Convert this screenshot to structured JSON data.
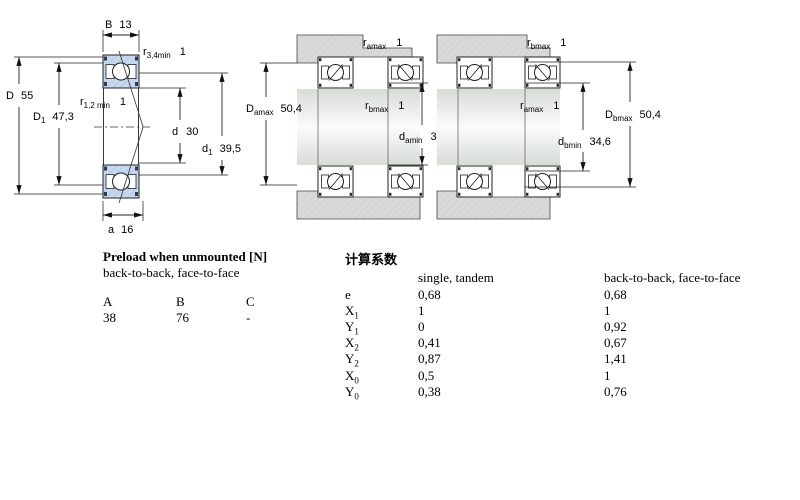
{
  "diagram_left": {
    "dims": {
      "B": {
        "sym": "B",
        "val": "13"
      },
      "r34": {
        "sym": "r",
        "sub": "3,4min",
        "val": "1"
      },
      "D": {
        "sym": "D",
        "val": "55"
      },
      "D1": {
        "sym": "D",
        "sub": "1",
        "val": "47,3"
      },
      "r12": {
        "sym": "r",
        "sub": "1,2 min",
        "val": "1"
      },
      "d": {
        "sym": "d",
        "val": "30"
      },
      "d1": {
        "sym": "d",
        "sub": "1",
        "val": "39,5"
      },
      "a": {
        "sym": "a",
        "val": "16"
      }
    }
  },
  "diagram_mid": {
    "dims": {
      "ramax": {
        "sym": "r",
        "sub": "amax",
        "val": "1"
      },
      "Damax": {
        "sym": "D",
        "sub": "amax",
        "val": "50,4"
      },
      "rbmax": {
        "sym": "r",
        "sub": "bmax",
        "val": "1"
      },
      "damin": {
        "sym": "d",
        "sub": "amin",
        "val": "34,6"
      }
    }
  },
  "diagram_right": {
    "dims": {
      "rbmax": {
        "sym": "r",
        "sub": "bmax",
        "val": "1"
      },
      "ramax": {
        "sym": "r",
        "sub": "amax",
        "val": "1"
      },
      "dbmin": {
        "sym": "d",
        "sub": "bmin",
        "val": "34,6"
      },
      "Dbmax": {
        "sym": "D",
        "sub": "bmax",
        "val": "50,4"
      }
    }
  },
  "preload_table": {
    "title": "Preload when unmounted [N]",
    "subtitle": "back-to-back, face-to-face",
    "columns": [
      "A",
      "B",
      "C"
    ],
    "values": [
      "38",
      "76",
      "-"
    ]
  },
  "factors_table": {
    "title": "计算系数",
    "col_single": "single, tandem",
    "col_btb": "back-to-back, face-to-face",
    "rows": [
      {
        "sym": "e",
        "sub": "",
        "single": "0,68",
        "btb": "0,68"
      },
      {
        "sym": "X",
        "sub": "1",
        "single": "1",
        "btb": "1"
      },
      {
        "sym": "Y",
        "sub": "1",
        "single": "0",
        "btb": "0,92"
      },
      {
        "sym": "X",
        "sub": "2",
        "single": "0,41",
        "btb": "0,67"
      },
      {
        "sym": "Y",
        "sub": "2",
        "single": "0,87",
        "btb": "1,41"
      },
      {
        "sym": "X",
        "sub": "0",
        "single": "0,5",
        "btb": "1"
      },
      {
        "sym": "Y",
        "sub": "0",
        "single": "0,38",
        "btb": "0,76"
      }
    ]
  },
  "colors": {
    "bearing_blue": "#c6d9ef",
    "housing_gray": "#d8d8d8",
    "shaft_light": "#f7faf7",
    "line_black": "#111111"
  }
}
